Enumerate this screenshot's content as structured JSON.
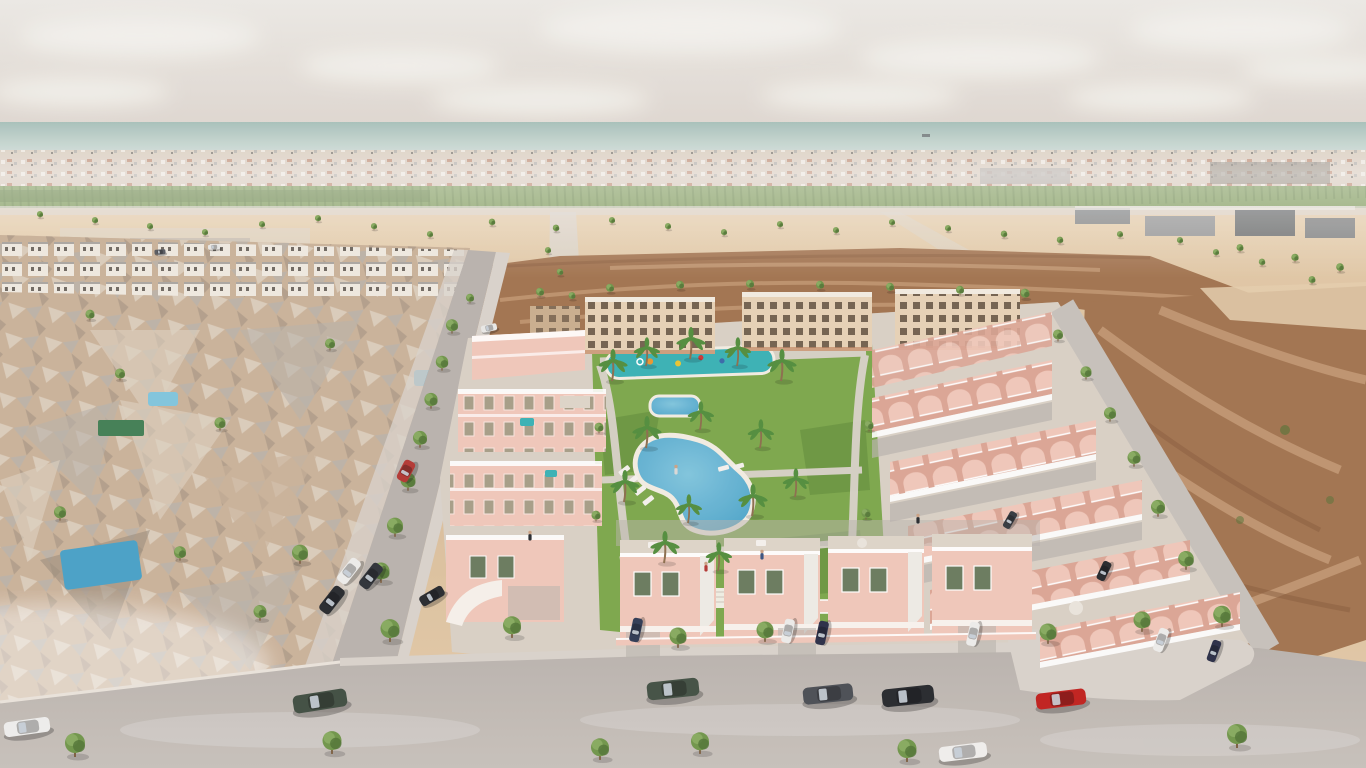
{
  "page": {
    "title": "Aerial 3D render — coastal residential development"
  },
  "scene": {
    "description": "Aerial 3D architectural rendering of a Mediterranean coastal new-build residential development: rows of salmon-pink townhouses with domed roof terraces arranged around a landscaped central park with a free-form swimming pool, a small pool, a kids splash pool, lawns and palm trees; cream three-storey apartment blocks and a brown undeveloped dirt field behind; an existing low-rise town rendered as a photogrammetry mesh on the left; a bare dirt plot on the right; tree-lined grey streets with parked cars in the foreground; sandy plots with young trees, green farmland, a distant white town strip and the sea with a tiny ship on the horizon under a pale hazy sky.",
    "palette": {
      "skyTop": "#ebe9e5",
      "skyLow": "#ddd6ce",
      "cloud": "#f5f3ef",
      "sea": "#a3beb7",
      "seaLight": "#c3d4cd",
      "townBand": "#d5c8b8",
      "townWhite": "#efe9e0",
      "townRoof": "#b57c62",
      "townGray": "#a9a5a0",
      "townDark": "#6d675f",
      "farm": "#7d9a5a",
      "farmDark": "#5e7b41",
      "sand": "#d7b995",
      "sandLight": "#e4cdab",
      "sandRoad": "#d9d3ca",
      "dirt": "#a0714c",
      "dirtLight": "#c79e78",
      "dirtDark": "#865a3a",
      "meshTan": "#c9b198",
      "meshGray": "#b8b1a9",
      "meshLight": "#ddd1c0",
      "meshDark": "#9a8c7b",
      "road": "#b8b2ac",
      "roadFore": "#c6c0ba",
      "sidewalk": "#d8d2cb",
      "curb": "#e9e3db",
      "houseWall": "#f0c7b9",
      "houseShade": "#dba493",
      "houseTrim": "#f8f3ee",
      "terrace": "#ddd4c8",
      "aptWall": "#e6d1b5",
      "aptShade": "#c9ad8d",
      "aptWin": "#5c4b3a",
      "aptRoof": "#f2ebe0",
      "aptCornice": "#c08662",
      "windowGreen": "#67795b",
      "windowDark": "#3f4a3a",
      "lawn": "#7aa648",
      "lawnDark": "#5d8a38",
      "pool": "#45a0c7",
      "poolLight": "#7ec4dd",
      "splash": "#35b0b4",
      "palmGreen": "#4e8c39",
      "treeGreen": "#6d9447",
      "treeDark": "#4c7031",
      "trunk": "#7a5c3e",
      "shipHull": "#5a5f63"
    },
    "inventory": {
      "townhouse_rows_right": 5,
      "front_townhouses": 4,
      "west_blocks": 3,
      "apartment_blocks": 3,
      "main_pools": 2,
      "kids_splash_pool": 1,
      "mesh_town_pools": 3,
      "palm_trees": 14,
      "trees": 62,
      "parked_cars": 22,
      "pedestrians": 5,
      "distant_ship": 1
    },
    "clouds": [
      [
        140,
        36,
        120,
        20
      ],
      [
        400,
        66,
        100,
        16
      ],
      [
        690,
        28,
        150,
        24
      ],
      [
        980,
        58,
        120,
        18
      ],
      [
        1240,
        30,
        110,
        20
      ],
      [
        80,
        92,
        90,
        14
      ],
      [
        540,
        100,
        110,
        15
      ],
      [
        860,
        96,
        100,
        14
      ],
      [
        1160,
        98,
        95,
        14
      ],
      [
        1320,
        70,
        80,
        12
      ]
    ],
    "trees": [
      [
        470,
        303,
        0.4,
        1
      ],
      [
        540,
        297,
        0.4,
        1
      ],
      [
        610,
        293,
        0.4,
        1
      ],
      [
        680,
        290,
        0.4,
        1
      ],
      [
        750,
        289,
        0.4,
        1
      ],
      [
        820,
        290,
        0.4,
        1
      ],
      [
        890,
        292,
        0.4,
        1
      ],
      [
        960,
        295,
        0.4,
        1
      ],
      [
        1025,
        299,
        0.45,
        1
      ],
      [
        40,
        218,
        0.3,
        1
      ],
      [
        95,
        224,
        0.3,
        1
      ],
      [
        150,
        230,
        0.3,
        1
      ],
      [
        205,
        236,
        0.3,
        1
      ],
      [
        262,
        228,
        0.3,
        1
      ],
      [
        318,
        222,
        0.3,
        1
      ],
      [
        374,
        230,
        0.3,
        1
      ],
      [
        430,
        238,
        0.3,
        1
      ],
      [
        492,
        226,
        0.32,
        1
      ],
      [
        556,
        232,
        0.32,
        1
      ],
      [
        612,
        224,
        0.3,
        1
      ],
      [
        668,
        230,
        0.3,
        1
      ],
      [
        724,
        236,
        0.3,
        1
      ],
      [
        780,
        228,
        0.3,
        1
      ],
      [
        836,
        234,
        0.3,
        1
      ],
      [
        892,
        226,
        0.3,
        1
      ],
      [
        948,
        232,
        0.3,
        1
      ],
      [
        1004,
        238,
        0.32,
        1
      ],
      [
        1060,
        244,
        0.32,
        1
      ],
      [
        1120,
        238,
        0.3,
        1
      ],
      [
        1180,
        244,
        0.3,
        1
      ],
      [
        1240,
        252,
        0.34,
        1
      ],
      [
        1295,
        262,
        0.36,
        1
      ],
      [
        1340,
        272,
        0.38,
        1
      ],
      [
        548,
        254,
        0.3,
        1
      ],
      [
        560,
        276,
        0.32,
        1
      ],
      [
        572,
        300,
        0.34,
        1
      ],
      [
        1216,
        256,
        0.3,
        1
      ],
      [
        1262,
        266,
        0.32,
        1
      ],
      [
        1312,
        284,
        0.34,
        1
      ],
      [
        452,
        333,
        0.6,
        0
      ],
      [
        442,
        370,
        0.62,
        0
      ],
      [
        431,
        408,
        0.66,
        0
      ],
      [
        420,
        447,
        0.7,
        0
      ],
      [
        408,
        490,
        0.75,
        0
      ],
      [
        395,
        536,
        0.8,
        0
      ],
      [
        381,
        582,
        0.85,
        0
      ],
      [
        300,
        563,
        0.8,
        0
      ],
      [
        390,
        641,
        0.95,
        0
      ],
      [
        512,
        637,
        0.9,
        0
      ],
      [
        678,
        647,
        0.85,
        0
      ],
      [
        765,
        641,
        0.85,
        0
      ],
      [
        1048,
        643,
        0.85,
        0
      ],
      [
        1142,
        631,
        0.85,
        0
      ],
      [
        75,
        756,
        1,
        0
      ],
      [
        332,
        753,
        0.95,
        0
      ],
      [
        600,
        759,
        0.9,
        0
      ],
      [
        700,
        753,
        0.9,
        0
      ],
      [
        907,
        761,
        0.95,
        0
      ],
      [
        1237,
        747,
        1,
        0
      ],
      [
        1058,
        341,
        0.5,
        0
      ],
      [
        1086,
        379,
        0.55,
        0
      ],
      [
        1110,
        421,
        0.6,
        0
      ],
      [
        1134,
        466,
        0.65,
        0
      ],
      [
        1158,
        516,
        0.7,
        0
      ],
      [
        1186,
        569,
        0.78,
        0
      ],
      [
        1222,
        626,
        0.88,
        0
      ],
      [
        599,
        433,
        0.45,
        0
      ],
      [
        596,
        521,
        0.45,
        0
      ],
      [
        869,
        431,
        0.45,
        0
      ],
      [
        866,
        519,
        0.45,
        0
      ],
      [
        120,
        380,
        0.5,
        0
      ],
      [
        220,
        430,
        0.55,
        0
      ],
      [
        60,
        520,
        0.6,
        0
      ],
      [
        180,
        560,
        0.6,
        0
      ],
      [
        260,
        620,
        0.65,
        0
      ],
      [
        90,
        320,
        0.45,
        0
      ],
      [
        330,
        350,
        0.5,
        0
      ]
    ],
    "palms": [
      [
        612,
        381,
        1
      ],
      [
        646,
        366,
        0.9
      ],
      [
        690,
        359,
        1
      ],
      [
        737,
        366,
        0.9
      ],
      [
        781,
        381,
        1
      ],
      [
        700,
        430,
        0.9
      ],
      [
        646,
        448,
        1
      ],
      [
        760,
        448,
        0.9
      ],
      [
        624,
        502,
        1
      ],
      [
        688,
        523,
        0.9
      ],
      [
        752,
        516,
        1
      ],
      [
        795,
        497,
        0.9
      ],
      [
        664,
        563,
        1
      ],
      [
        718,
        571,
        0.9
      ]
    ],
    "cars": [
      [
        27,
        727,
        46,
        15,
        -8,
        "#eeeeec"
      ],
      [
        320,
        701,
        54,
        18,
        -9,
        "#3d4b3f"
      ],
      [
        673,
        689,
        52,
        18,
        -6,
        "#3f4d41"
      ],
      [
        828,
        694,
        50,
        17,
        -6,
        "#474b52"
      ],
      [
        908,
        696,
        52,
        18,
        -6,
        "#22252a"
      ],
      [
        963,
        752,
        48,
        15,
        -7,
        "#f0efed"
      ],
      [
        1061,
        699,
        50,
        16,
        -7,
        "#bf1d1a"
      ],
      [
        332,
        600,
        30,
        13,
        -52,
        "#23262b"
      ],
      [
        349,
        571,
        28,
        12,
        -52,
        "#ececea"
      ],
      [
        371,
        576,
        28,
        12,
        -52,
        "#2b2f35"
      ],
      [
        406,
        471,
        22,
        12,
        -62,
        "#b23430"
      ],
      [
        489,
        328,
        16,
        7,
        -12,
        "#e8e8e6"
      ],
      [
        636,
        630,
        24,
        10,
        -78,
        "#2c3752"
      ],
      [
        788,
        631,
        24,
        10,
        -78,
        "#ebebe9"
      ],
      [
        822,
        633,
        24,
        10,
        -78,
        "#262b44"
      ],
      [
        973,
        634,
        24,
        10,
        -78,
        "#ececea"
      ],
      [
        1161,
        640,
        24,
        10,
        -70,
        "#ececea"
      ],
      [
        1214,
        651,
        22,
        9,
        -70,
        "#262b44"
      ],
      [
        1104,
        571,
        20,
        9,
        -65,
        "#22252a"
      ],
      [
        1010,
        520,
        18,
        8,
        -60,
        "#31363d"
      ],
      [
        432,
        596,
        26,
        11,
        -30,
        "#23262b"
      ],
      [
        214,
        247,
        12,
        5,
        -4,
        "#e6e6e4"
      ],
      [
        160,
        252,
        11,
        5,
        -4,
        "#55585e"
      ]
    ],
    "people": [
      [
        706,
        571,
        "#b23430"
      ],
      [
        762,
        559,
        "#35507e"
      ],
      [
        676,
        474,
        "#d8d8d6"
      ],
      [
        918,
        523,
        "#23262b"
      ],
      [
        530,
        540,
        "#23262b"
      ]
    ],
    "ship": {
      "x": 922,
      "y": 134
    }
  }
}
